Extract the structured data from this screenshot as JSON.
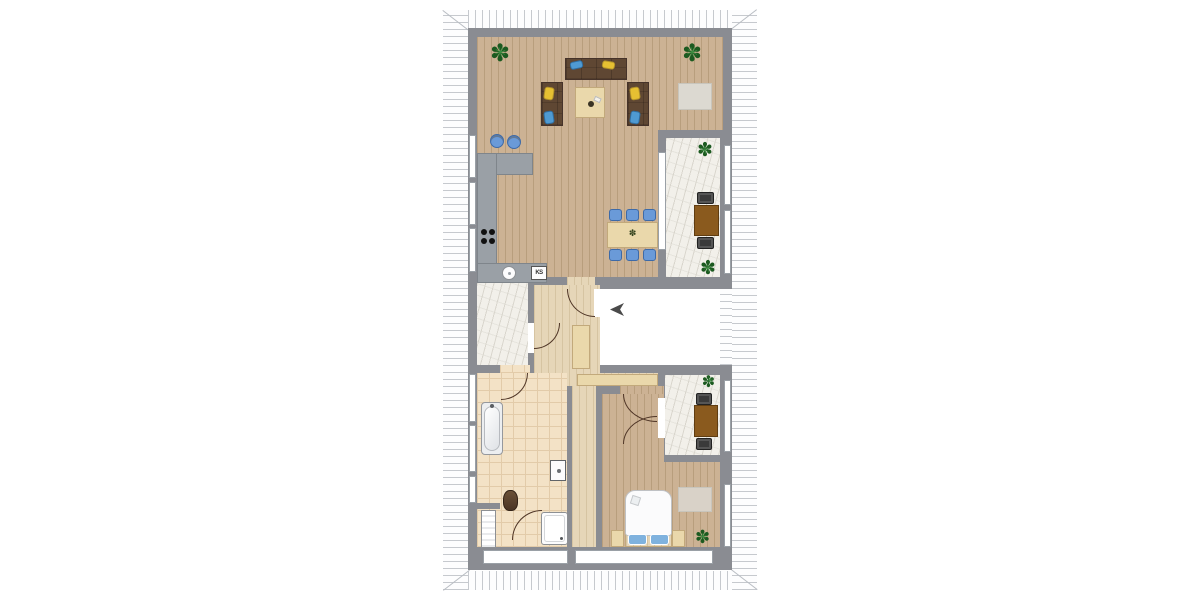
{
  "floorplan": {
    "type": "apartment-floor-plan-top-view",
    "labels": {
      "fridge": "KS"
    },
    "glyphs": {
      "plant_outer": "✽",
      "plant_inner": "✳"
    },
    "colors": {
      "wall": "#8a8c92",
      "roofline": "#c6c9ce",
      "roofbg": "#fdfdfe",
      "wood": "#ccb294",
      "woodline": "#b89e7d",
      "palewood": "#e6d6b8",
      "paleline": "#d6c4a2",
      "tile": "#f3e2c6",
      "tileline": "#e2cba9",
      "marble": "#f2f0ea",
      "marblevein": "#d9d6cd",
      "counter": "#9aa0a6",
      "counteredge": "#7f858b",
      "chairblue": "#6a9ad8",
      "chairedge": "#3d6aa8",
      "sofabrown": "#5f4733",
      "pillowblue": "#4f9ad2",
      "pillowyellow": "#e6c032",
      "tablewood": "#ead8ab",
      "tableedge": "#c2a97b",
      "balconytable": "#8a5a1e",
      "balconytableedge": "#5f3c10",
      "darkchair": "#3a3a3a",
      "plantdark": "#1c5a20",
      "plantlight": "#3f8f43",
      "rug": "#dcd9d1",
      "rugedge": "#c8c5bc",
      "arc": "#4f3526",
      "arrow": "#4a4a4a",
      "window": "#ffffff",
      "windowedge": "#9aa0a6",
      "toilet": "#5b4331",
      "fixture": "#fcfcfd",
      "fixtureedge": "#8d9094"
    },
    "rooms": {
      "living_room": "open living area",
      "kitchen": "kitchen",
      "dining": "dining area",
      "hallway": "hallway",
      "stairwell": "stairwell entrance",
      "bathroom": "bathroom",
      "bedroom": "bedroom",
      "balcony_upper": "balcony",
      "balcony_left": "balcony",
      "balcony_bedroom": "balcony"
    }
  }
}
